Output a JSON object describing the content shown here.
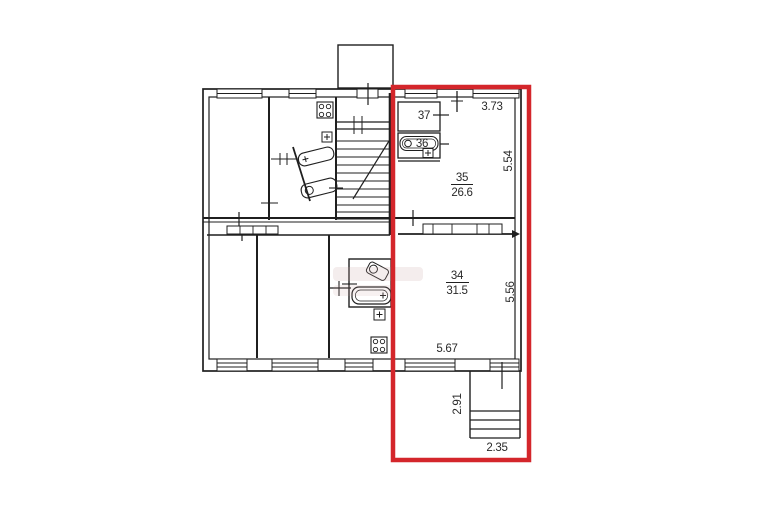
{
  "plan": {
    "highlight_color": "#d4262b",
    "rooms": [
      {
        "number": "37"
      },
      {
        "number": "36"
      },
      {
        "number": "35",
        "area": "26.6"
      },
      {
        "number": "34",
        "area": "31.5"
      }
    ],
    "dimensions": {
      "room35_width": "3.73",
      "room35_depth": "5.54",
      "room34_depth": "5.56",
      "room34_width": "5.67",
      "porch_depth": "2.91",
      "porch_width": "2.35"
    }
  }
}
